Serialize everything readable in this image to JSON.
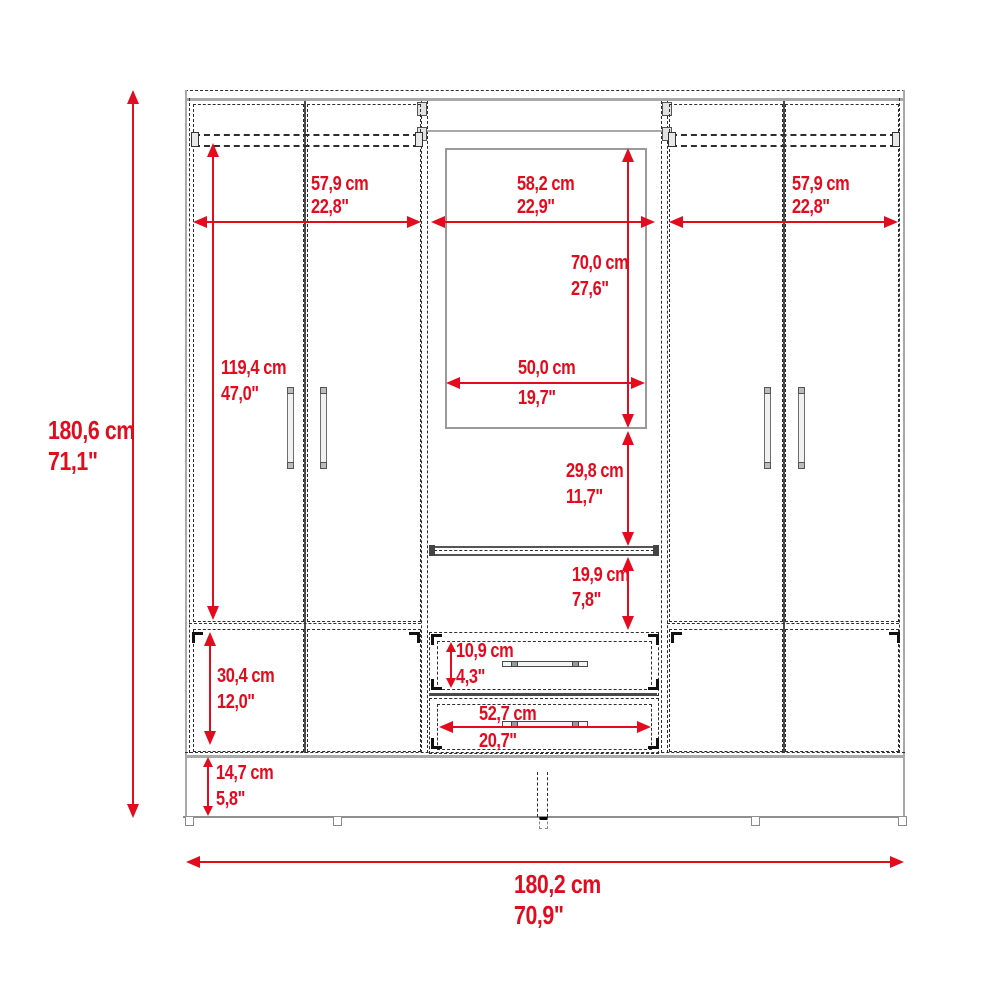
{
  "diagram": {
    "title": "wardrobe-front-elevation-dimension-drawing",
    "accent_color": "#e30b1e",
    "outline_color": "#a9a9a9",
    "hidden_line_color": "#2e2e2e"
  },
  "dims": {
    "overall_height": {
      "cm": "180,6 cm",
      "in": "71,1\""
    },
    "overall_width": {
      "cm": "180,2 cm",
      "in": "70,9\""
    },
    "left_section_width": {
      "cm": "57,9 cm",
      "in": "22,8\""
    },
    "center_section_width": {
      "cm": "58,2 cm",
      "in": "22,9\""
    },
    "right_section_width": {
      "cm": "57,9 cm",
      "in": "22,8\""
    },
    "mirror_height": {
      "cm": "70,0 cm",
      "in": "27,6\""
    },
    "mirror_width": {
      "cm": "50,0 cm",
      "in": "19,7\""
    },
    "side_door_height": {
      "cm": "119,4 cm",
      "in": "47,0\""
    },
    "mirror_to_shelf": {
      "cm": "29,8 cm",
      "in": "11,7\""
    },
    "shelf_to_drawers": {
      "cm": "19,9 cm",
      "in": "7,8\""
    },
    "top_drawer_height": {
      "cm": "10,9 cm",
      "in": "4,3\""
    },
    "drawer_width": {
      "cm": "52,7 cm",
      "in": "20,7\""
    },
    "lower_door_height": {
      "cm": "30,4 cm",
      "in": "12,0\""
    },
    "base_height": {
      "cm": "14,7 cm",
      "in": "5,8\""
    }
  }
}
